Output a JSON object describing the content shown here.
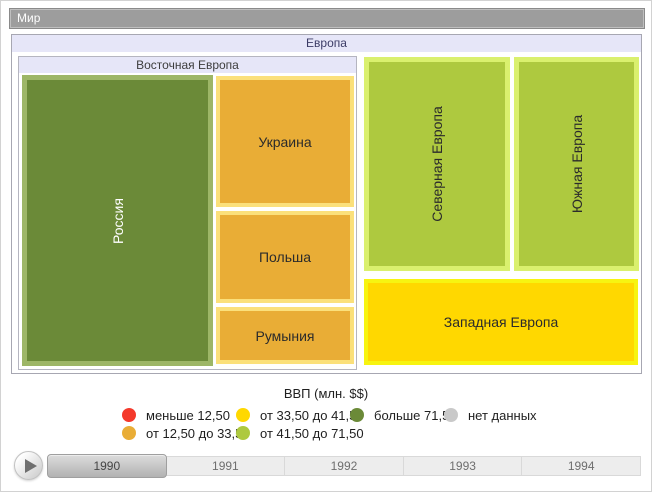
{
  "window": {
    "breadcrumb": "Мир"
  },
  "treemap": {
    "root": "Европа",
    "eastern": {
      "label": "Восточная Европа"
    },
    "nodes": {
      "russia": {
        "label": "Россия",
        "fill": "#6b8a38",
        "border": "#9db667"
      },
      "ukraine": {
        "label": "Украина",
        "fill": "#e9ad36",
        "border": "#fbe07b"
      },
      "poland": {
        "label": "Польша",
        "fill": "#e9ad36",
        "border": "#fbe07b"
      },
      "romania": {
        "label": "Румыния",
        "fill": "#e9ad36",
        "border": "#fbe07b"
      },
      "northern": {
        "label": "Северная Европа",
        "fill": "#aec93f",
        "border": "#daf06e"
      },
      "southern": {
        "label": "Южная Европа",
        "fill": "#aec93f",
        "border": "#daf06e"
      },
      "western": {
        "label": "Западная Европа",
        "fill": "#ffd800",
        "border": "#f7f411"
      }
    }
  },
  "legend": {
    "title": "ВВП (млн. $$)",
    "items": [
      {
        "label": "меньше 12,50",
        "color": "#f4392b"
      },
      {
        "label": "от 12,50 до 33,50",
        "color": "#e9ad36"
      },
      {
        "label": "от 33,50 до 41,50",
        "color": "#ffd800"
      },
      {
        "label": "от 41,50 до 71,50",
        "color": "#aec93f"
      },
      {
        "label": "больше 71,50",
        "color": "#6b8a38"
      },
      {
        "label": "нет данных",
        "color": "#c9c9c9"
      }
    ]
  },
  "timeline": {
    "years": [
      "1990",
      "1991",
      "1992",
      "1993",
      "1994"
    ],
    "selected": "1990"
  },
  "chart_data": {
    "type": "treemap",
    "title": "ВВП (млн. $$)",
    "breadcrumb": "Мир",
    "period_selected": "1990",
    "periods": [
      "1990",
      "1991",
      "1992",
      "1993",
      "1994"
    ],
    "legend_bins": [
      {
        "label": "меньше 12,50",
        "color": "#f4392b"
      },
      {
        "label": "от 12,50 до 33,50",
        "color": "#e9ad36"
      },
      {
        "label": "от 33,50 до 41,50",
        "color": "#ffd800"
      },
      {
        "label": "от 41,50 до 71,50",
        "color": "#aec93f"
      },
      {
        "label": "больше 71,50",
        "color": "#6b8a38"
      },
      {
        "label": "нет данных",
        "color": "#c9c9c9"
      }
    ],
    "root": {
      "name": "Мир",
      "children": [
        {
          "name": "Европа",
          "children": [
            {
              "name": "Восточная Европа",
              "children": [
                {
                  "name": "Россия",
                  "bin": "больше 71,50"
                },
                {
                  "name": "Украина",
                  "bin": "от 12,50 до 33,50"
                },
                {
                  "name": "Польша",
                  "bin": "от 12,50 до 33,50"
                },
                {
                  "name": "Румыния",
                  "bin": "от 12,50 до 33,50"
                }
              ]
            },
            {
              "name": "Северная Европа",
              "bin": "от 41,50 до 71,50"
            },
            {
              "name": "Южная Европа",
              "bin": "от 41,50 до 71,50"
            },
            {
              "name": "Западная Европа",
              "bin": "от 33,50 до 41,50"
            }
          ]
        }
      ]
    }
  }
}
